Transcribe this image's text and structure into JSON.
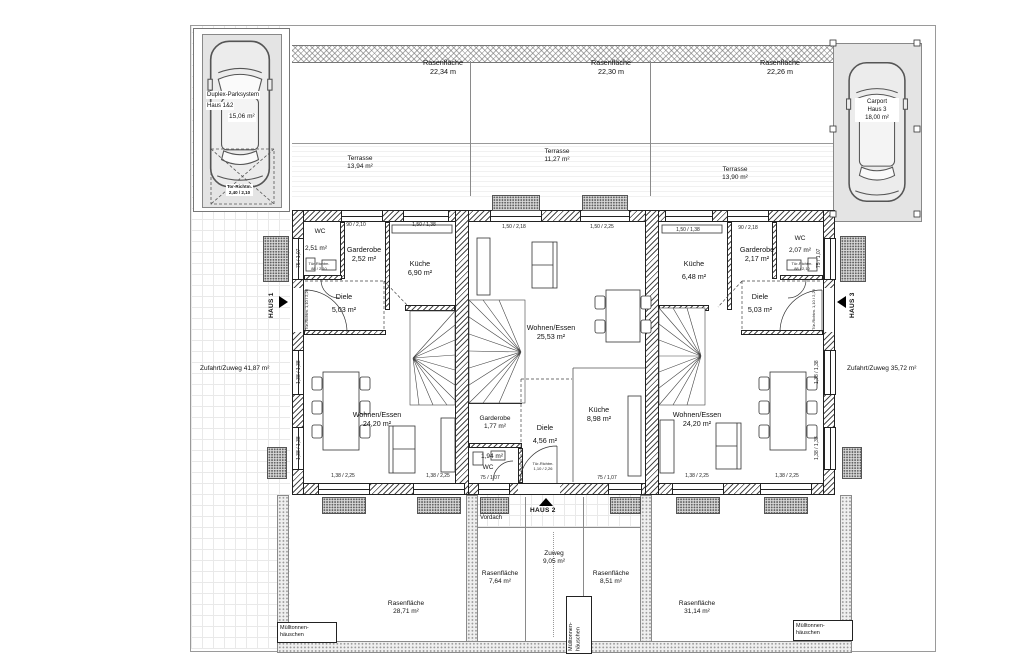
{
  "plan": {
    "parking": {
      "title": "Duplex-Parksystem",
      "subtitle": "Haus 1&2",
      "area": "15,06 m²",
      "gate_label": "Tor-Richtm.",
      "gate_dim": "2,40 / 2,10"
    },
    "carport": {
      "title": "Carport",
      "subtitle": "Haus 3",
      "area": "18,00 m²"
    },
    "lawns_top": [
      {
        "name": "Rasenfläche",
        "area": "22,34 m"
      },
      {
        "name": "Rasenfläche",
        "area": "22,30 m"
      },
      {
        "name": "Rasenfläche",
        "area": "22,26 m"
      }
    ],
    "terraces": [
      {
        "name": "Terrasse",
        "area": "13,94 m²"
      },
      {
        "name": "Terrasse",
        "area": "11,27 m²"
      },
      {
        "name": "Terrasse",
        "area": "13,90 m²"
      }
    ],
    "driveways": {
      "left": {
        "name": "Zufahrt/Zuweg",
        "area": "41,87 m²"
      },
      "right": {
        "name": "Zufahrt/Zuweg",
        "area": "35,72 m²"
      }
    },
    "markers": {
      "h1": "HAUS 1",
      "h2": "HAUS 2",
      "h3": "HAUS 3"
    },
    "house1": {
      "wc": {
        "name": "WC",
        "area": "2,51 m²"
      },
      "garderobe": {
        "name": "Garderobe",
        "area": "2,52 m²"
      },
      "kueche": {
        "name": "Küche",
        "area": "6,90 m²"
      },
      "diele": {
        "name": "Diele",
        "area": "5,03 m²"
      },
      "wohnen": {
        "name": "Wohnen/Essen",
        "area": "24,20 m²"
      }
    },
    "house2": {
      "wohnen": {
        "name": "Wohnen/Essen",
        "area": "25,53 m²"
      },
      "garderobe": {
        "name": "Garderobe",
        "area": "1,77 m²"
      },
      "diele": {
        "name": "Diele",
        "area": "4,56 m²"
      },
      "kueche": {
        "name": "Küche",
        "area": "8,98 m²"
      },
      "wc": {
        "name": "WC",
        "area": "1,94 m²"
      }
    },
    "house3": {
      "kueche": {
        "name": "Küche",
        "area": "6,48 m²"
      },
      "garderobe": {
        "name": "Garderobe",
        "area": "2,17 m²"
      },
      "wc": {
        "name": "WC",
        "area": "2,07 m²"
      },
      "diele": {
        "name": "Diele",
        "area": "5,03 m²"
      },
      "wohnen": {
        "name": "Wohnen/Essen",
        "area": "24,20 m²"
      }
    },
    "bottom": {
      "vordach": "Vordach",
      "zuweg": {
        "name": "Zuweg",
        "area": "9,05 m²"
      },
      "lawn_left": {
        "name": "Rasenfläche",
        "area": "28,71 m²"
      },
      "lawn_mid_left": {
        "name": "Rasenfläche",
        "area": "7,64 m²"
      },
      "lawn_mid_right": {
        "name": "Rasenfläche",
        "area": "8,51 m²"
      },
      "lawn_right": {
        "name": "Rasenfläche",
        "area": "31,14 m²"
      },
      "trash_l1": "Mülltonnen-",
      "trash_l2": "häuschen"
    },
    "dims": {
      "h1_top_a": "90 / 2,10",
      "h1_top_b": "1,50 / 1,38",
      "h2_top_a": "1,50 / 2,18",
      "h2_top_b": "1,50 / 2,25",
      "h3_top_a": "1,50 / 1,38",
      "h3_top_b": "90 / 2,18",
      "h1_bottom_a": "1,38 / 2,25",
      "h1_bottom_b": "1,38 / 2,25",
      "h2_bottom_wc": "75 / 1,07",
      "h2_bottom_k": "75 / 1,07",
      "h3_bottom_a": "1,38 / 2,25",
      "h3_bottom_b": "1,38 / 2,25",
      "h1_left_wc": "75 / 1,07",
      "h1_left_a": "1,38 / 1,38",
      "h1_left_b": "1,38 / 1,38",
      "h3_right_wc": "75 / 1,07",
      "h3_right_a": "1,38 / 1,38",
      "h3_right_b": "1,38 / 1,38"
    },
    "doors": {
      "h1_wc_l1": "Tür-Richtm.",
      "h1_wc_l2": "88 / 2,10",
      "h3_wc_l1": "Tür-Richtm.",
      "h3_wc_l2": "88 / 2,10",
      "h1_entry": "Tür-Richtm. 1,10 / 2,26",
      "h3_entry": "Tür-Richtm. 1,10 / 2,26",
      "h2_entry_l1": "Tür-Richtm.",
      "h2_entry_l2": "1,10 / 2,26"
    },
    "colors": {
      "wall": "#4a4a4a",
      "pad": "#e4e4e4",
      "paper": "#ffffff"
    }
  }
}
